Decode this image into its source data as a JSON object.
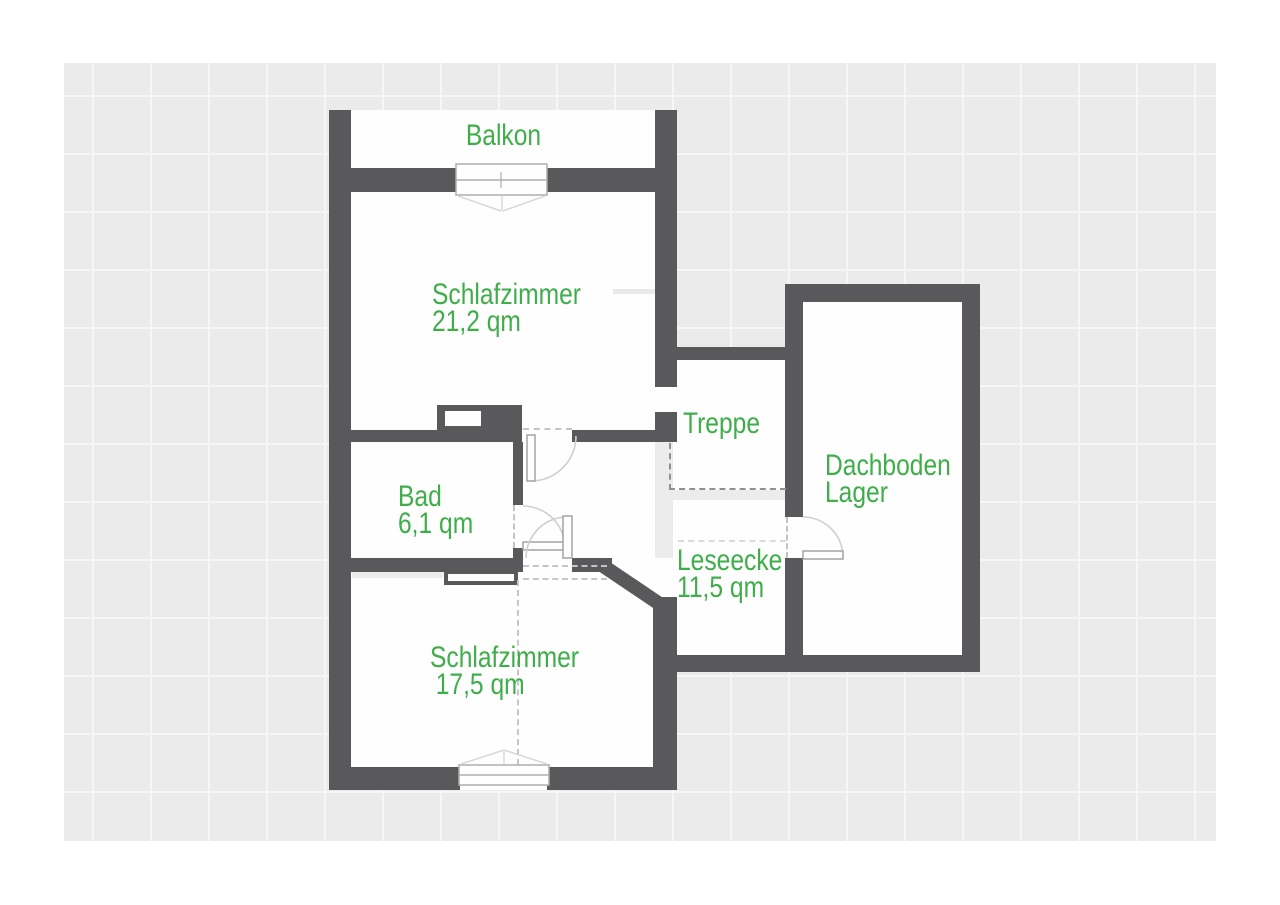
{
  "floorplan": {
    "rooms": {
      "balkon": {
        "label": "Balkon"
      },
      "schlafzimmer_top": {
        "label": "Schlafzimmer",
        "area": "21,2 qm"
      },
      "treppe": {
        "label": "Treppe"
      },
      "dachboden": {
        "label": "Dachboden",
        "sublabel": "Lager"
      },
      "bad": {
        "label": "Bad",
        "area": "6,1 qm"
      },
      "leseecke": {
        "label": "Leseecke",
        "area": "11,5 qm"
      },
      "schlafzimmer_bottom": {
        "label": "Schlafzimmer",
        "area": "17,5 qm"
      }
    },
    "colors": {
      "wall": "#59595B",
      "label_green": "#3FAE4A",
      "canvas_gray": "#EBEBEB",
      "room_white": "#FEFEFE",
      "ghost_gray": "#ECECEC"
    }
  }
}
